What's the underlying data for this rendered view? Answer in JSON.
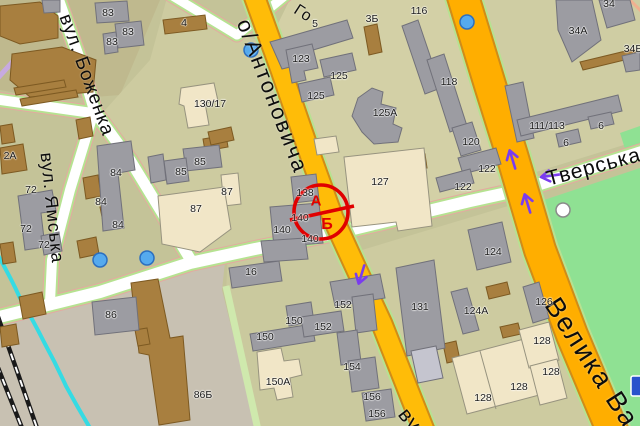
{
  "palette": {
    "base": "#c4c398",
    "block_light": "#d3d0a6",
    "block_mid": "#cdcba0",
    "block_south": "#cac99e",
    "block_se": "#cdcba0",
    "block_ne": "#cfcda3",
    "block_industrial": "#c8c1b2",
    "block_topleft": "#bfb98e",
    "park": "#8fe193",
    "road_white": "#ffffff",
    "road_green": "#b6e291",
    "road_pink": "#e4a9a0",
    "road_casing": "#d08c18",
    "road_yellow": "#ffbc08",
    "road_yellow2": "#ffae00",
    "alley_green": "#cfe9ad",
    "rail": "#1a1a1a",
    "stream": "#35dbe3",
    "lavender": "#c7aae0",
    "bldg_gray": "#9c9ca2",
    "bldg_gray_stroke": "#71717a",
    "bldg_brown": "#a87f3f",
    "bldg_brown_stroke": "#7d5a22",
    "bldg_cream": "#f1e6c7",
    "bldg_cream_stroke": "#97937f",
    "bldg_silver": "#c5c5cf",
    "dot_fill": "#55aaee",
    "dot_stroke": "#2b6fc0",
    "arrow": "#7a3cee",
    "metro": "#2952cc",
    "marker_red": "#e00000",
    "label": "#1c1c1c",
    "street_label": "#0d0d0d"
  },
  "streets": [
    {
      "id": "bozhenka",
      "t": "вул. Боженка",
      "x": 64,
      "y": 4,
      "rot": 70,
      "size": 19,
      "ls": 1
    },
    {
      "id": "yamska",
      "t": "вул. Ямська",
      "x": 46,
      "y": 142,
      "rot": 84,
      "size": 18,
      "ls": 1
    },
    {
      "id": "antonovycha",
      "t": "о/Антоновича",
      "x": 243,
      "y": 7,
      "rot": 69,
      "size": 22,
      "ls": 2
    },
    {
      "id": "velyka-vasylkivska",
      "t": "Велика Ва",
      "x": 551,
      "y": 285,
      "rot": 57,
      "size": 27,
      "ls": 2
    },
    {
      "id": "tverska",
      "t": "Тверська",
      "x": 547,
      "y": 168,
      "rot": -15,
      "size": 21,
      "ls": 1
    },
    {
      "id": "fragment-vu",
      "t": "ву",
      "x": 402,
      "y": 399,
      "rot": 52,
      "size": 21,
      "ls": 1
    },
    {
      "id": "fragment-go",
      "t": "Го",
      "x": 295,
      "y": 0,
      "rot": 33,
      "size": 16,
      "ls": 1
    },
    {
      "id": "fragment-ka",
      "t": "ка",
      "x": -14,
      "y": 68,
      "rot": 72,
      "size": 18,
      "ls": 1
    }
  ],
  "building_numbers": [
    {
      "t": "83",
      "x": 108,
      "y": 13
    },
    {
      "t": "4",
      "x": 184,
      "y": 23
    },
    {
      "t": "83",
      "x": 128,
      "y": 32
    },
    {
      "t": "83",
      "x": 112,
      "y": 42
    },
    {
      "t": "5",
      "x": 315,
      "y": 24
    },
    {
      "t": "3Б",
      "x": 372,
      "y": 19
    },
    {
      "t": "116",
      "x": 419,
      "y": 11
    },
    {
      "t": "34",
      "x": 609,
      "y": 4
    },
    {
      "t": "34А",
      "x": 578,
      "y": 31
    },
    {
      "t": "34Б",
      "x": 633,
      "y": 49
    },
    {
      "t": "123",
      "x": 301,
      "y": 59
    },
    {
      "t": "125",
      "x": 339,
      "y": 76
    },
    {
      "t": "125",
      "x": 316,
      "y": 96
    },
    {
      "t": "125А",
      "x": 385,
      "y": 113
    },
    {
      "t": "130/17",
      "x": 210,
      "y": 104
    },
    {
      "t": "118",
      "x": 449,
      "y": 82
    },
    {
      "t": "111/113",
      "x": 547,
      "y": 126
    },
    {
      "t": "6",
      "x": 601,
      "y": 126
    },
    {
      "t": "6",
      "x": 566,
      "y": 143
    },
    {
      "t": "120",
      "x": 471,
      "y": 142
    },
    {
      "t": "122",
      "x": 487,
      "y": 169
    },
    {
      "t": "122",
      "x": 463,
      "y": 187
    },
    {
      "t": "124",
      "x": 493,
      "y": 252
    },
    {
      "t": "85",
      "x": 200,
      "y": 162
    },
    {
      "t": "85",
      "x": 181,
      "y": 172
    },
    {
      "t": "87",
      "x": 227,
      "y": 192
    },
    {
      "t": "87",
      "x": 196,
      "y": 209
    },
    {
      "t": "2А",
      "x": 10,
      "y": 156
    },
    {
      "t": "72",
      "x": 31,
      "y": 190
    },
    {
      "t": "72",
      "x": 26,
      "y": 229
    },
    {
      "t": "72",
      "x": 44,
      "y": 245
    },
    {
      "t": "84",
      "x": 116,
      "y": 173
    },
    {
      "t": "84",
      "x": 101,
      "y": 202
    },
    {
      "t": "84",
      "x": 118,
      "y": 225
    },
    {
      "t": "127",
      "x": 380,
      "y": 182
    },
    {
      "t": "138",
      "x": 305,
      "y": 193
    },
    {
      "t": "140",
      "x": 300,
      "y": 218
    },
    {
      "t": "140",
      "x": 282,
      "y": 230
    },
    {
      "t": "140",
      "x": 310,
      "y": 239
    },
    {
      "t": "16",
      "x": 251,
      "y": 272
    },
    {
      "t": "86",
      "x": 111,
      "y": 315
    },
    {
      "t": "86Б",
      "x": 203,
      "y": 395
    },
    {
      "t": "131",
      "x": 420,
      "y": 307
    },
    {
      "t": "150",
      "x": 294,
      "y": 321
    },
    {
      "t": "150",
      "x": 265,
      "y": 337
    },
    {
      "t": "152",
      "x": 343,
      "y": 305
    },
    {
      "t": "152",
      "x": 323,
      "y": 327
    },
    {
      "t": "154",
      "x": 352,
      "y": 367
    },
    {
      "t": "156",
      "x": 372,
      "y": 397
    },
    {
      "t": "156",
      "x": 377,
      "y": 414
    },
    {
      "t": "150А",
      "x": 278,
      "y": 382
    },
    {
      "t": "124А",
      "x": 476,
      "y": 311
    },
    {
      "t": "126",
      "x": 544,
      "y": 302
    },
    {
      "t": "128",
      "x": 542,
      "y": 341
    },
    {
      "t": "128",
      "x": 551,
      "y": 372
    },
    {
      "t": "128",
      "x": 519,
      "y": 387
    },
    {
      "t": "128",
      "x": 483,
      "y": 398
    }
  ],
  "marker": {
    "letters": [
      {
        "t": "А",
        "x": 316,
        "y": 201,
        "size": 15
      },
      {
        "t": "Б",
        "x": 327,
        "y": 225,
        "size": 16
      }
    ]
  },
  "pois": {
    "blue_dots": [
      {
        "x": 251,
        "y": 50
      },
      {
        "x": 467,
        "y": 22
      },
      {
        "x": 100,
        "y": 260
      },
      {
        "x": 147,
        "y": 258
      }
    ],
    "white_circle": {
      "x": 563,
      "y": 210,
      "r": 7
    },
    "metro_box": {
      "x": 631,
      "y": 376,
      "w": 16,
      "h": 20
    }
  },
  "arrows": [
    {
      "x": 361,
      "y": 276,
      "rot": 197
    },
    {
      "x": 512,
      "y": 158,
      "rot": -17
    },
    {
      "x": 527,
      "y": 202,
      "rot": -17
    },
    {
      "x": 549,
      "y": 176,
      "rot": -98
    }
  ]
}
